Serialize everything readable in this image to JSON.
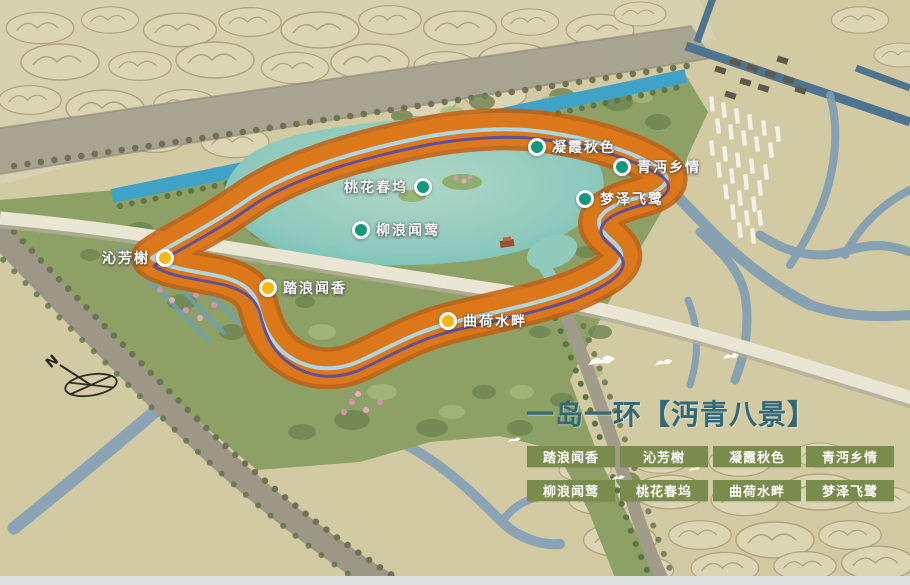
{
  "map": {
    "title_overlay": "一岛一环【沔青八景】",
    "compass": {
      "label": "N"
    },
    "markers": [
      {
        "label": "凝霞秋色",
        "x": 537,
        "y": 147,
        "dot_color": "#12997c",
        "label_side": "right"
      },
      {
        "label": "青沔乡情",
        "x": 622,
        "y": 167,
        "dot_color": "#12997c",
        "label_side": "right"
      },
      {
        "label": "桃花春坞",
        "x": 423,
        "y": 187,
        "dot_color": "#12997c",
        "label_side": "left"
      },
      {
        "label": "梦泽飞鹭",
        "x": 585,
        "y": 199,
        "dot_color": "#12997c",
        "label_side": "right"
      },
      {
        "label": "柳浪闻莺",
        "x": 361,
        "y": 230,
        "dot_color": "#12997c",
        "label_side": "right"
      },
      {
        "label": "沁芳榭",
        "x": 165,
        "y": 258,
        "dot_color": "#f6b713",
        "label_side": "left"
      },
      {
        "label": "踏浪闻香",
        "x": 268,
        "y": 288,
        "dot_color": "#f6b713",
        "label_side": "right"
      },
      {
        "label": "曲荷水畔",
        "x": 448,
        "y": 321,
        "dot_color": "#f6b713",
        "label_side": "right"
      }
    ],
    "route_ring": {
      "band_color": "#e07a1a",
      "edge_color": "#c35e0e",
      "line_light_blue": "#aadbee",
      "line_purple": "#5a4d9f"
    }
  },
  "panel": {
    "title": "一岛一环【沔青八景】",
    "title_color": "#336879",
    "legend": {
      "badge_color": "#7a8c4b",
      "text_color": "#ffffff",
      "items": [
        "踏浪闻香",
        "沁芳榭",
        "凝霞秋色",
        "青沔乡情",
        "柳浪闻莺",
        "桃花春坞",
        "曲荷水畔",
        "梦泽飞鹭"
      ]
    }
  },
  "colors": {
    "paper_beige": "#d2caa2",
    "lake_teal": "#8fcabd",
    "canal_blue": "#3fa3c8",
    "river_grey_blue": "#7e9db4",
    "park_green": "#8da167",
    "marker_teal": "#12997c",
    "marker_yellow": "#f6b713"
  }
}
